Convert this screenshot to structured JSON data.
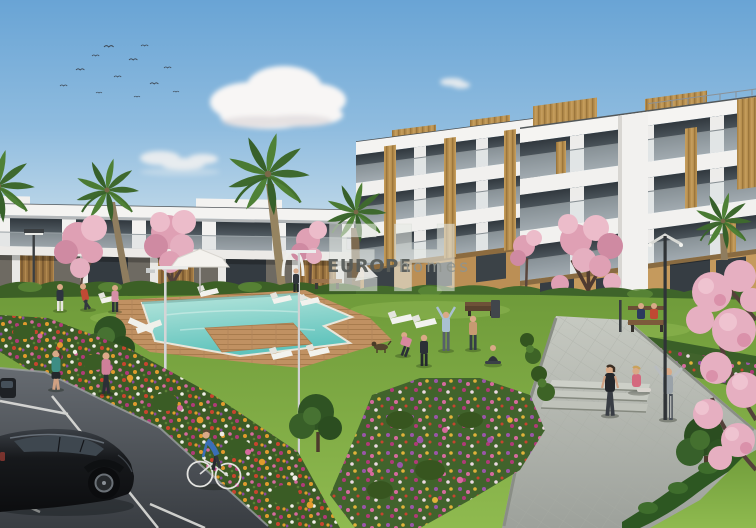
{
  "page": {
    "type": "property-listing-render",
    "width_px": 756,
    "height_px": 528
  },
  "watermark": {
    "monogram": "EH",
    "brand_primary": "EUROPE",
    "brand_secondary": "homes"
  },
  "scene": {
    "description": "3D architectural rendering of a modern white residential complex: three-storey apartment blocks with glass balconies and wood accents, a two-storey row on the left, communal swimming pool with wooden deck and sun loungers, lawns, flower beds, palm and pink blossom trees, street lamps, benches, people jogging and exercising, a cyclist, and a black car parked on an asphalt road.",
    "elements": [
      "sky",
      "birds",
      "clouds",
      "apartment building right",
      "apartment building center",
      "apartment row left",
      "roof terrace railing",
      "palm trees",
      "pink blossom trees",
      "green trees",
      "hedges",
      "lawn",
      "swimming pool",
      "wooden pool deck",
      "sun loungers",
      "white parasol",
      "street lamps",
      "benches",
      "trash bin",
      "flower beds",
      "paved walkway",
      "walkway steps",
      "asphalt road with parking lines",
      "partially visible parked car",
      "black hatchback car",
      "cyclist",
      "joggers",
      "people exercising",
      "people seated on bench",
      "dog"
    ],
    "palette": {
      "sky_top": "#69a4d5",
      "sky_horizon": "#e9eff1",
      "cloud_white": "#f8f6f5",
      "building_white": "#f4f3f1",
      "window_glass": "#41484f",
      "balcony_glass": "#d3dcdf",
      "wood_accent": "#b8904f",
      "ground_floor_amber": "#c59a5d",
      "lawn_green": "#7aa43f",
      "hedge_green": "#3c6026",
      "pool_water": "#7ccec7",
      "deck_wood": "#c09162",
      "blossom_pink": "#e3a8bb",
      "flower_orange": "#e09b2d",
      "flower_magenta": "#b03a78",
      "asphalt_gray": "#4a4f55",
      "walkway_gray": "#b9bcb6",
      "car_black": "#17191c",
      "cyclist_shirt": "#3a6fb5"
    }
  }
}
